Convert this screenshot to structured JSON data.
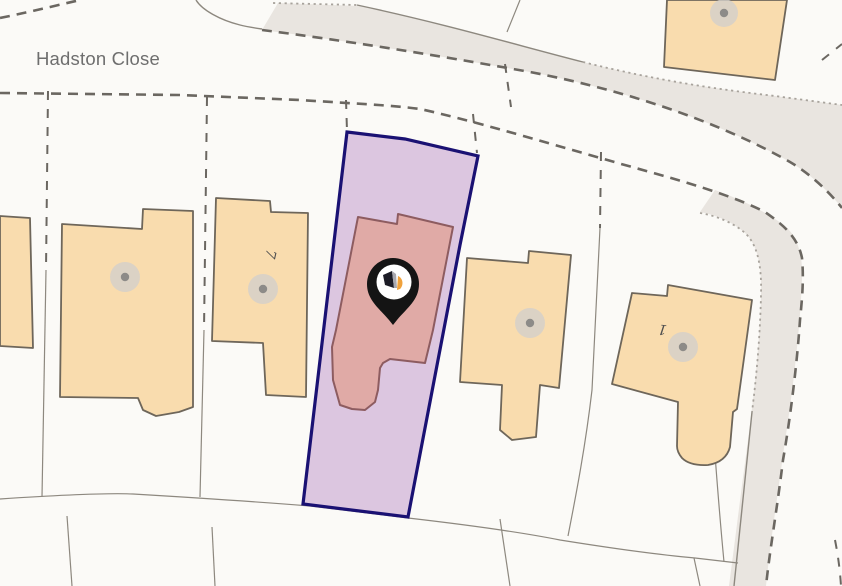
{
  "labels": {
    "street_name": "Hadston Close",
    "house_numbers": [
      "7",
      "1"
    ]
  },
  "marker": {
    "type": "property-location-pin"
  },
  "highlight": {
    "description": "selected property parcel and building"
  },
  "colors": {
    "background": "#fbfaf7",
    "road_fill": "#e9e5e0",
    "building_fill": "#f9dcae",
    "building_stroke": "#6e665a",
    "dashed_line": "#6b6761",
    "dotted_line": "#a8a39c",
    "thin_line": "#8d887f",
    "label_text": "#6e6e6e",
    "number_text": "#4f4f4f",
    "dot_fill": "#8d8b88",
    "dot_halo": "#d3cfcb",
    "parcel_fill": "#dcc6e0",
    "parcel_stroke": "#1a1173",
    "hl_building_fill": "#e0aaa6",
    "hl_building_stroke": "#8d5c60",
    "pin_color": "#141414",
    "pin_accent": "#f0a23c"
  }
}
